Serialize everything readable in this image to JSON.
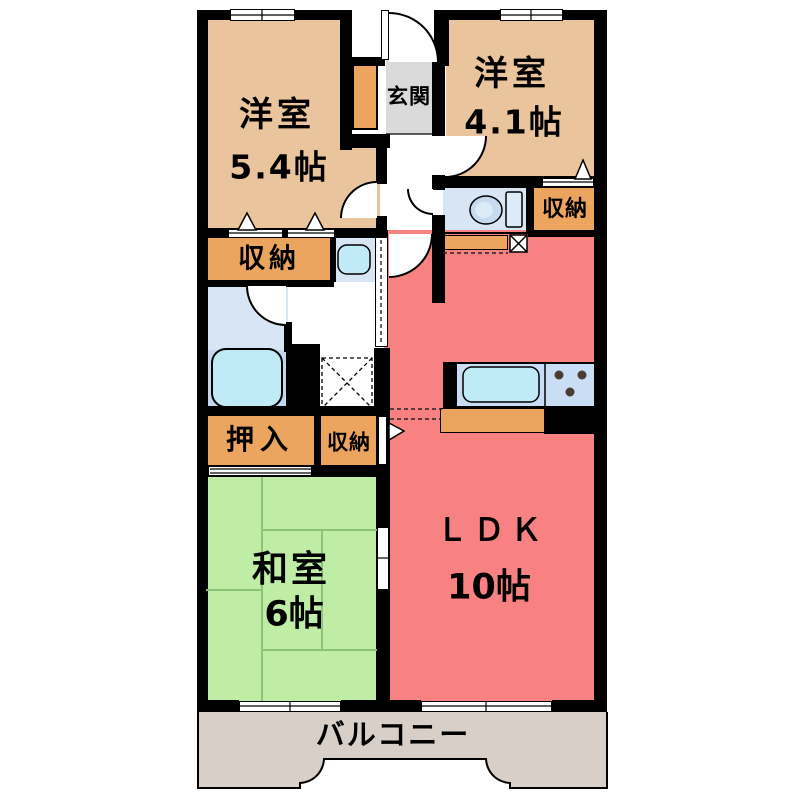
{
  "plan_title": "apartment floor plan",
  "colors": {
    "wall": "#000000",
    "western_room": "#eac49c",
    "storage": "#eca55f",
    "ldk": "#f88181",
    "tatami": "#bfeda6",
    "tatami_line": "#8cc474",
    "entrance_floor": "#dadada",
    "balcony_floor": "#d8d0c8",
    "water_floor": "#d8e5f4",
    "bath_floor": "#c3d8ee",
    "fixture_fill": "#c0eaf6",
    "counter_fill": "#c9def4",
    "stove_dot": "#4a3b33"
  },
  "rooms": {
    "western_room_1": {
      "name": "洋室",
      "area": "5.4帖"
    },
    "western_room_2": {
      "name": "洋室",
      "area": "4.1帖"
    },
    "japanese_room": {
      "name": "和室",
      "area": "6帖"
    },
    "ldk": {
      "name": "ＬＤＫ",
      "area": "10帖"
    },
    "entrance": {
      "name": "玄関"
    },
    "balcony": {
      "name": "バルコニー"
    }
  },
  "storage": {
    "closet_top_left": {
      "name": "収納"
    },
    "closet_by_toilet": {
      "name": "収納"
    },
    "closet_by_ldk": {
      "name": "収納"
    },
    "oshiire": {
      "name": "押入"
    }
  },
  "fixtures": [
    "toilet",
    "bathtub",
    "wash-basin",
    "kitchen-sink",
    "gas-stove",
    "washing-machine-pan",
    "meter-box",
    "entrance-door",
    "hinged-doors",
    "sliding-doors",
    "windows"
  ]
}
